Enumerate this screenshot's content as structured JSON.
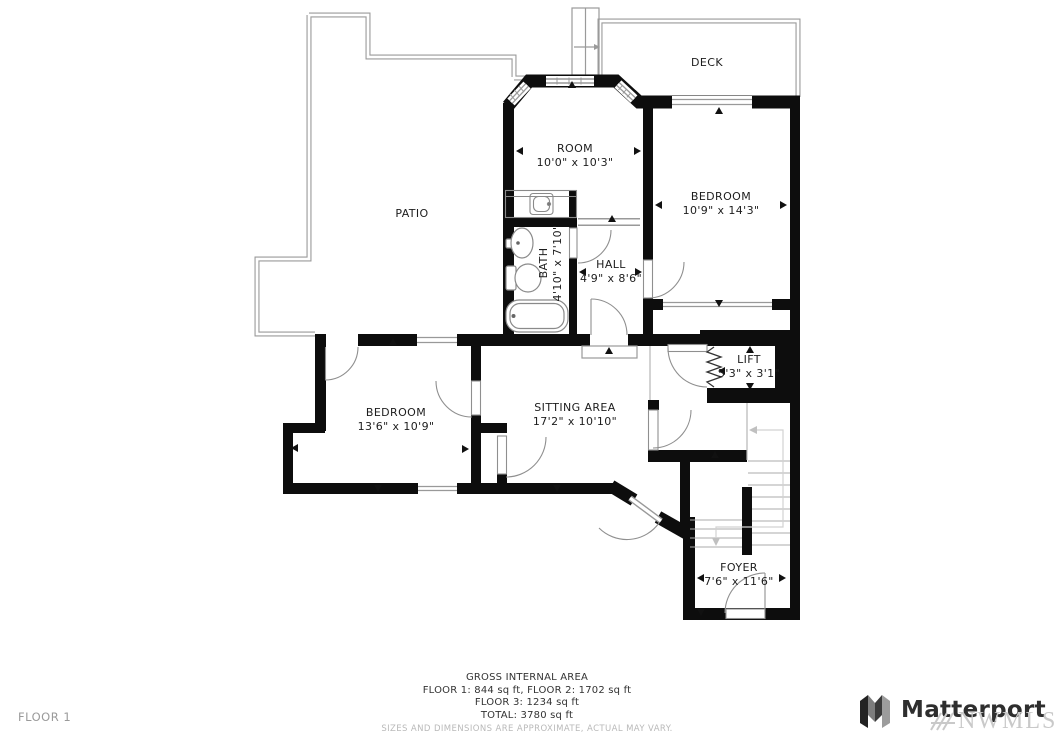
{
  "floor_plan": {
    "rooms": [
      {
        "name": "DECK",
        "dims": ""
      },
      {
        "name": "ROOM",
        "dims": "10'0\" x 10'3\""
      },
      {
        "name": "BEDROOM",
        "dims": "10'9\" x 14'3\""
      },
      {
        "name": "PATIO",
        "dims": ""
      },
      {
        "name": "HALL",
        "dims": "4'9\" x 8'6\""
      },
      {
        "name": "BATH",
        "dims": "4'10\" x 7'10\""
      },
      {
        "name": "LIFT",
        "dims": "5'3\" x 3'1\""
      },
      {
        "name": "BEDROOM",
        "dims": "13'6\" x 10'9\""
      },
      {
        "name": "SITTING AREA",
        "dims": "17'2\" x 10'10\""
      },
      {
        "name": "FOYER",
        "dims": "7'6\" x 11'6\""
      }
    ],
    "wall_color": "#0d0d0d",
    "outline_color": "#9a9a9a"
  },
  "footer": {
    "title": "GROSS INTERNAL AREA",
    "line1": "FLOOR 1: 844 sq ft, FLOOR 2: 1702 sq ft",
    "line2": "FLOOR 3: 1234 sq ft",
    "line3": "TOTAL: 3780 sq ft",
    "disclaimer": "SIZES AND DIMENSIONS ARE APPROXIMATE, ACTUAL MAY VARY.",
    "floor_label": "FLOOR 1"
  },
  "branding": {
    "logo_text": "Matterport",
    "watermark": "NWMLS"
  }
}
